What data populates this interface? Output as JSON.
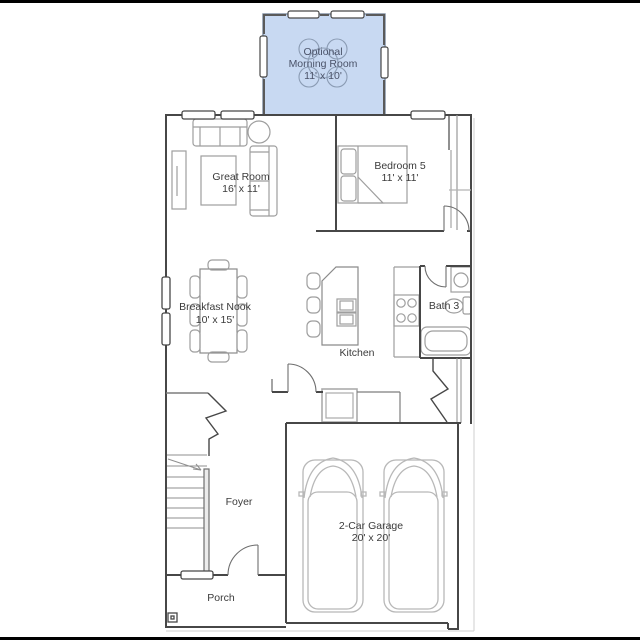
{
  "scene": {
    "letterbox": "#000000",
    "background": "#ffffff"
  },
  "colors": {
    "wall": "#474747",
    "furniture": "#9e9e9e",
    "car": "#b8b8b8",
    "light": "#cfcfcf",
    "label": "#3b3b3b",
    "morning_fill": "#c8d9f2",
    "morning_stroke": "#7b8aa0",
    "morning_sketch": "#8b9cb4",
    "morning_label": "#4a5268"
  },
  "rooms": {
    "morning": {
      "line1": "Optional",
      "line2": "Morning Room",
      "dims": "11' x 10'"
    },
    "great": {
      "name": "Great Room",
      "dims": "16' x 11'"
    },
    "bedroom5": {
      "name": "Bedroom 5",
      "dims": "11' x 11'"
    },
    "breakfast": {
      "name": "Breakfast Nook",
      "dims": "10' x 15'"
    },
    "kitchen": {
      "name": "Kitchen"
    },
    "bath3": {
      "name": "Bath 3"
    },
    "foyer": {
      "name": "Foyer"
    },
    "garage": {
      "name": "2-Car Garage",
      "dims": "20' x 20'"
    },
    "porch": {
      "name": "Porch"
    }
  }
}
